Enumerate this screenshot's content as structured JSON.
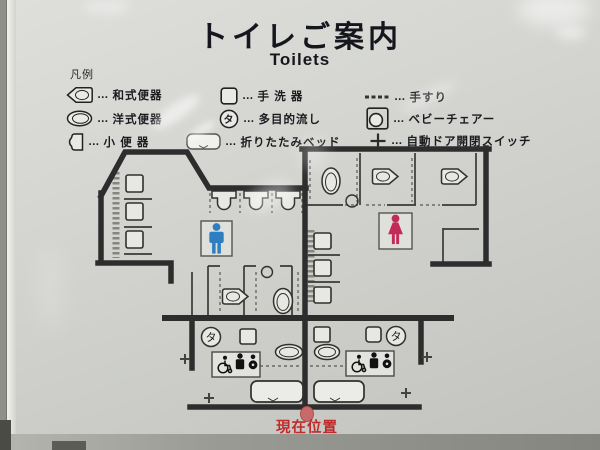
{
  "header": {
    "title": "トイレご案内",
    "subtitle": "Toilets"
  },
  "legend": {
    "label": "凡例",
    "separator": "…",
    "items": [
      {
        "name": "squat-toilet",
        "label": "和式便器"
      },
      {
        "name": "western-toilet",
        "label": "洋式便器"
      },
      {
        "name": "urinal",
        "label": "小 便 器"
      },
      {
        "name": "hand-wash-basin",
        "label": "手 洗 器"
      },
      {
        "name": "multipurpose-sink",
        "label": "多目的流し"
      },
      {
        "name": "folding-bed",
        "label": "折りたたみベッド"
      },
      {
        "name": "handrail",
        "label": "手すり"
      },
      {
        "name": "baby-chair",
        "label": "ベビーチェアー"
      },
      {
        "name": "auto-door-switch",
        "label": "自動ドア開閉スイッチ"
      }
    ]
  },
  "symbols": {
    "multipurpose_sink": "タ"
  },
  "map": {
    "current_location": "現在位置"
  },
  "colors": {
    "men_pictogram": "#2e7fc2",
    "women_pictogram": "#c22a57",
    "current_location_text": "#bf2b2b",
    "current_location_marker": "#c76a6a",
    "wall": "#2d2d2d",
    "panel": "#d2d3cf"
  }
}
